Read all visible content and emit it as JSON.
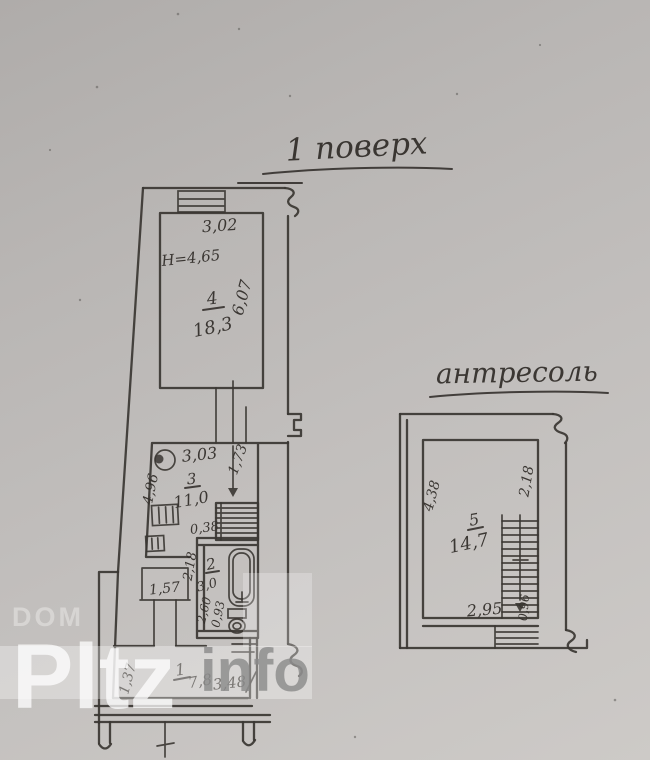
{
  "document": {
    "type": "hand-drawn floor plan scan",
    "colors": {
      "paper": "#c0bdbb",
      "ink": "#3a3632",
      "watermark_white": "#ffffff",
      "watermark_gray": "#8a8a8a"
    }
  },
  "watermark": {
    "top": "DOM",
    "main": "Pltz",
    "suffix": "info"
  },
  "first_floor": {
    "title": "1 поверх",
    "room4": {
      "number": "4",
      "area": "18,3",
      "width": "3,02",
      "depth": "6,07",
      "height": "H=4,65"
    },
    "room3": {
      "number": "3",
      "area": "11,0",
      "width": "3,03",
      "side": "4,96",
      "stair_dim": "1,73",
      "niche": "0,38",
      "dim_a": "2,18",
      "dim_b": "1,57"
    },
    "room2": {
      "number": "2",
      "area": "3,0",
      "dim_a": "2,60",
      "dim_b": "0,93"
    },
    "room1": {
      "number": "1",
      "area": "7,8",
      "side": "1,37",
      "width": "3,48"
    }
  },
  "mezzanine": {
    "title": "антресоль",
    "room5": {
      "number": "5",
      "area": "14,7",
      "side_left": "4,38",
      "side_right": "2,18",
      "width": "2,95",
      "stair_dim": "0,96"
    }
  }
}
